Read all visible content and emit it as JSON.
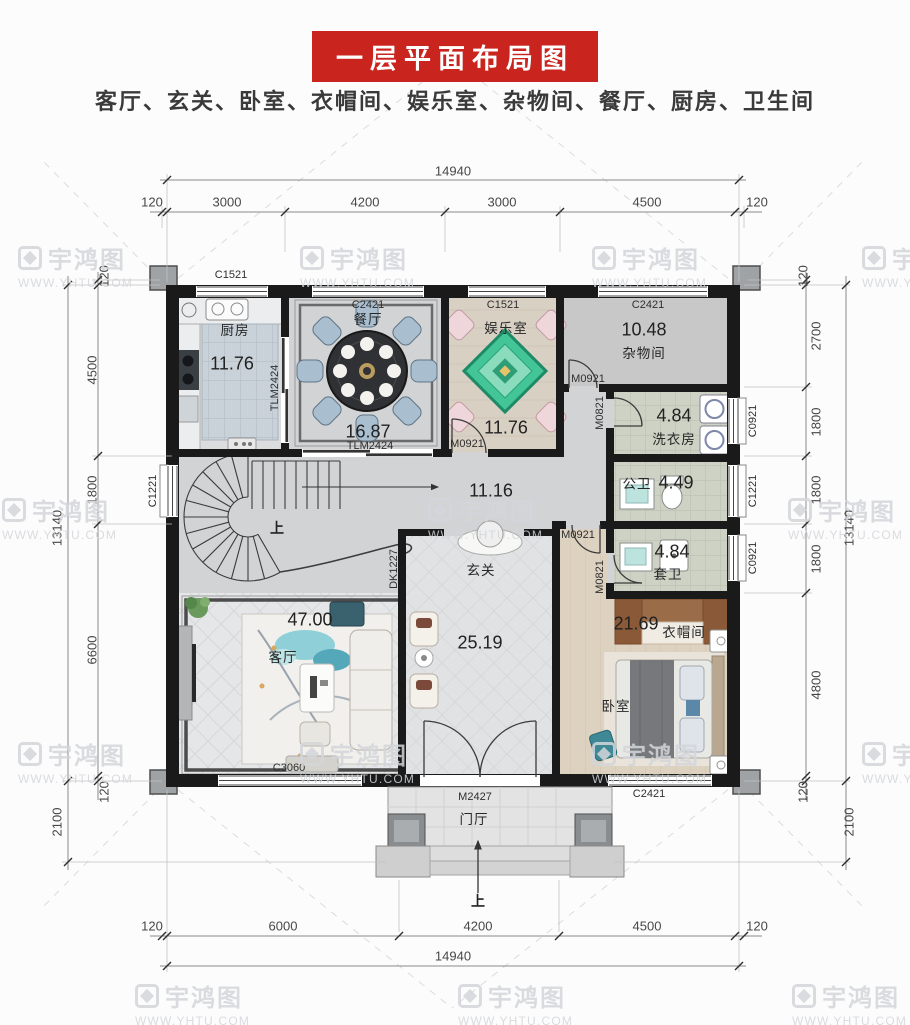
{
  "header": {
    "title": "一层平面布局图",
    "subtitle": "客厅、玄关、卧室、衣帽间、娱乐室、杂物间、餐厅、厨房、卫生间"
  },
  "watermark": {
    "brand": "宇鸿图",
    "url": "WWW.YHTU.COM"
  },
  "rooms": {
    "kitchen": {
      "name": "厨房",
      "area": "11.76"
    },
    "dining": {
      "name": "餐厅",
      "area": "16.87"
    },
    "entertainment": {
      "name": "娱乐室",
      "area": "11.76"
    },
    "storage": {
      "name": "杂物间",
      "area": "10.48"
    },
    "laundry": {
      "name": "洗衣房",
      "area": "4.84"
    },
    "public_bath": {
      "name": "公卫",
      "area": "4.49"
    },
    "ensuite_bath": {
      "name": "套卫",
      "area": "4.84"
    },
    "hall": {
      "area": "11.16"
    },
    "foyer": {
      "name": "玄关",
      "area": "25.19"
    },
    "living": {
      "name": "客厅",
      "area": "47.00"
    },
    "bedroom": {
      "name": "卧室",
      "area": "21.69"
    },
    "cloakroom": {
      "name": "衣帽间"
    },
    "porch": {
      "name": "门厅"
    }
  },
  "labels": {
    "up": "上"
  },
  "openings": {
    "c1521": "C1521",
    "c2421": "C2421",
    "c0921": "C0921",
    "c1221": "C1221",
    "c3060": "C3060",
    "tlm2424": "TLM2424",
    "m0921": "M0921",
    "m0821": "M0821",
    "m2427": "M2427",
    "dk1227": "DK1227"
  },
  "dims": {
    "top": {
      "overall": "14940",
      "segments": [
        "120",
        "3000",
        "4200",
        "3000",
        "4500",
        "120"
      ]
    },
    "bottom": {
      "overall": "14940",
      "segments": [
        "120",
        "6000",
        "4200",
        "4500",
        "120"
      ]
    },
    "left": {
      "overall": "13140",
      "segments": [
        "120",
        "4500",
        "1800",
        "6600",
        "120"
      ],
      "porch_depth": "2100"
    },
    "right": {
      "overall": "13140",
      "segments": [
        "120",
        "2700",
        "1800",
        "1800",
        "1800",
        "4800",
        "120"
      ],
      "porch_depth": "2100"
    }
  },
  "colors": {
    "banner": "#c9241e",
    "wall": "#1a1a1a",
    "dim_text": "#474747",
    "watermark": "#d3d6da"
  }
}
